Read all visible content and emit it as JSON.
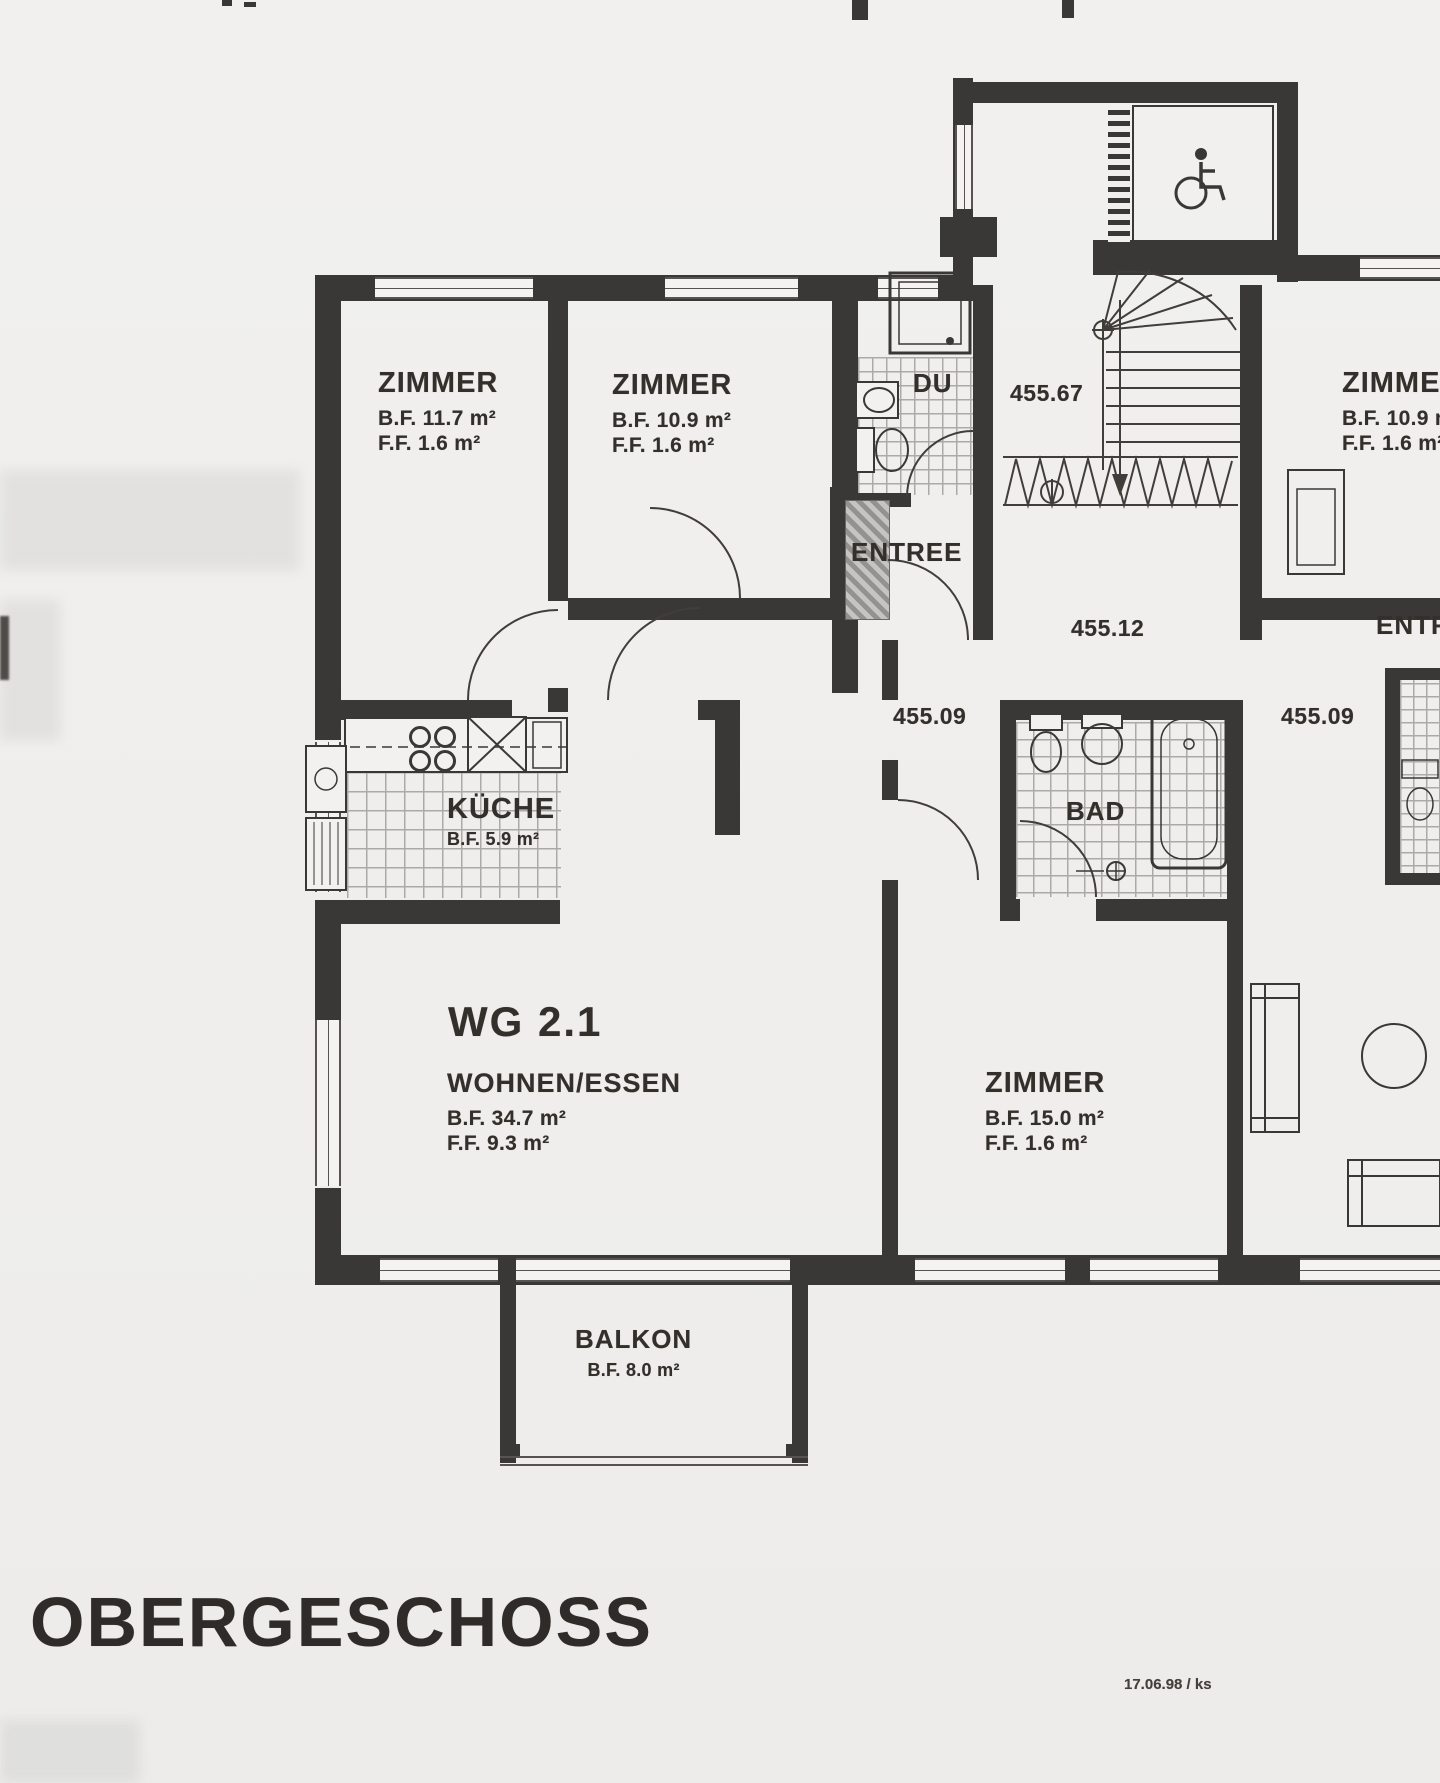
{
  "title": "OBERGESCHOSS",
  "stamp": "17.06.98 / ks",
  "unit_label": "WG 2.1",
  "rooms": {
    "zimmer_nw": {
      "name": "ZIMMER",
      "bf": "B.F. 11.7 m²",
      "ff": "F.F. 1.6 m²"
    },
    "zimmer_n": {
      "name": "ZIMMER",
      "bf": "B.F. 10.9 m²",
      "ff": "F.F. 1.6 m²"
    },
    "zimmer_mid": {
      "name": "ZIMMER",
      "bf": "B.F. 15.0 m²",
      "ff": "F.F. 1.6 m²"
    },
    "zimmer_e": {
      "name": "ZIMMER",
      "bf": "B.F. 10.9 m²",
      "ff": "F.F. 1.6 m²"
    },
    "kueche": {
      "name": "KÜCHE",
      "bf": "B.F. 5.9 m²"
    },
    "wohnen_essen": {
      "name": "WOHNEN/ESSEN",
      "bf": "B.F. 34.7 m²",
      "ff": "F.F. 9.3 m²"
    },
    "balkon": {
      "name": "BALKON",
      "bf": "B.F. 8.0 m²"
    },
    "du": {
      "name": "DU"
    },
    "bad": {
      "name": "BAD"
    },
    "entree_west": {
      "name": "ENTREE"
    },
    "entree_east": {
      "name": "ENTREE"
    }
  },
  "elevations": {
    "stairwell": "455.67",
    "hall": "455.12",
    "threshold_west": "455.09",
    "threshold_east": "455.09"
  },
  "colors": {
    "wall": "#3a3836",
    "paper": "#f0efec",
    "ink": "#34302c"
  }
}
